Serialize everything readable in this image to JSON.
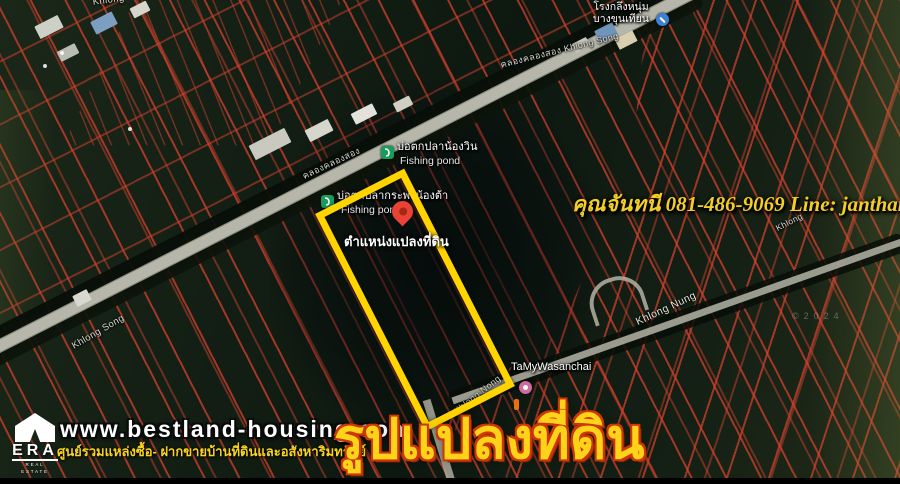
{
  "colors": {
    "plot_outline_yellow": "#FFD400",
    "parcel_line_red": "#D6402E",
    "road_gray": "#B6B6AA",
    "pin_red": "#EA4335",
    "poi_green": "#179C5B",
    "poi_blue": "#3F7FD6",
    "poi_pink": "#CF6B9E",
    "contact_yellow": "#F2CF27",
    "title_yellow": "#FFD317",
    "title_outline": "#CD3708"
  },
  "map_labels": {
    "machine_shop": {
      "line1": "โรงกลึงหนุ่ม",
      "line2": "บางขุนเทียน"
    },
    "road_top": "คลองคลองสอง   Khlong Song",
    "road_mid": "คลองคลองสอง",
    "road_top_left_partial": "Khlong",
    "fishing_pond_1": {
      "name": "บ่อตกปลาน้องวิน",
      "sub": "Fishing pond"
    },
    "fishing_pond_2": {
      "name": "บ่อตกปลากระพงน้องต้า",
      "sub": "Fishing pond"
    },
    "khlong_song_left": "Khlong Song",
    "khlong_nung_right": "Khlong Nung",
    "khlong_partial_right": "Khlong",
    "khlong_nong_bottom": "Khlong Nong",
    "shop_bottom": "TaMyWasanchai",
    "watermark": "©2024"
  },
  "plot": {
    "marker_label": "ตำแหน่งแปลงที่ดิน"
  },
  "overlay": {
    "contact": "คุณจันทนี 081-486-9069  Line: janthanee.pu",
    "big_title": "รูปแปลงที่ดิน"
  },
  "banner": {
    "website": "www.bestland-housing.com",
    "tagline": "ศูนย์รวมแหล่งซื้อ- ฝากขายบ้านที่ดินและอสังหาริมทรัพย์",
    "era_logo": {
      "name": "ERA",
      "sub": "REAL ESTATE"
    }
  },
  "icons": {
    "location_pin": "map-pin",
    "fishing_pond": "fishing-rod",
    "machine_shop": "wrench",
    "shop": "shopping-bag"
  }
}
